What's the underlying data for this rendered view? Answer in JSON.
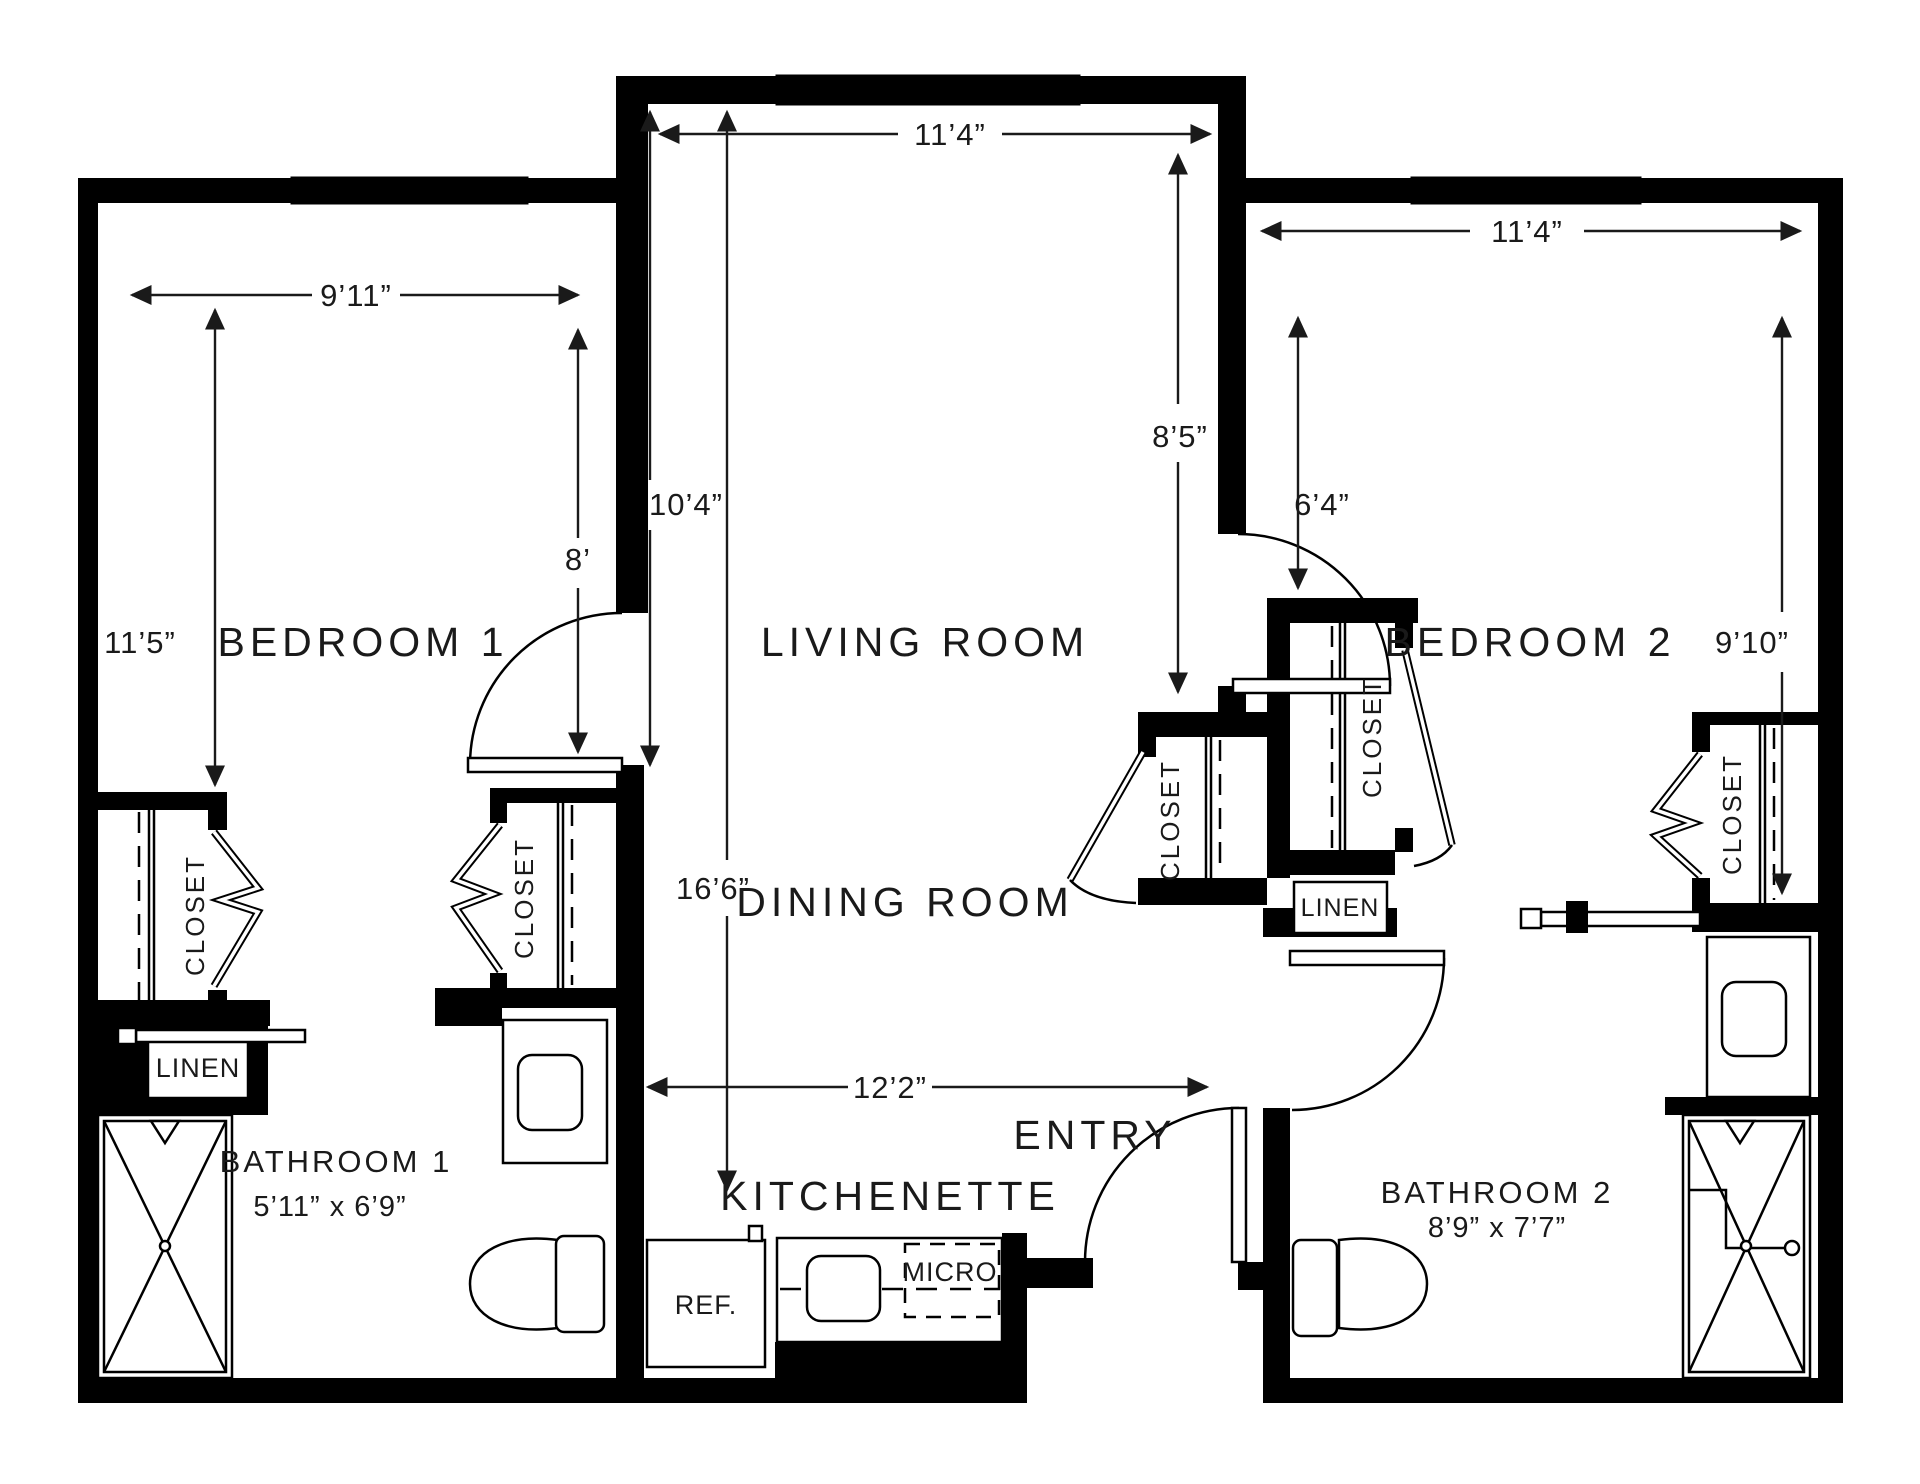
{
  "rooms": {
    "bedroom1": "BEDROOM 1",
    "living": "LIVING ROOM",
    "bedroom2": "BEDROOM 2",
    "dining": "DINING ROOM",
    "entry": "ENTRY",
    "kitchenette": "KITCHENETTE",
    "bathroom1": {
      "name": "BATHROOM 1",
      "dims": "5’11” x 6’9”"
    },
    "bathroom2": {
      "name": "BATHROOM 2",
      "dims": "8’9” x 7’7”"
    }
  },
  "storage": {
    "closet": "CLOSET",
    "linen": "LINEN"
  },
  "appliances": {
    "fridge": "REF.",
    "microwave": "MICRO"
  },
  "dimensions": {
    "bedroom1_width": "9’11”",
    "bedroom1_left": "11’5”",
    "bedroom1_right": "8’",
    "living_width": "11’4”",
    "living_left_upper": "10’4”",
    "living_left_total": "16’6”",
    "living_right": "8’5”",
    "bedroom2_width": "11’4”",
    "bedroom2_left": "6’4”",
    "bedroom2_right": "9’10”",
    "hall_width": "12’2”"
  },
  "colors": {
    "wall": "#000000",
    "text": "#1a1a1a",
    "background": "#ffffff"
  }
}
